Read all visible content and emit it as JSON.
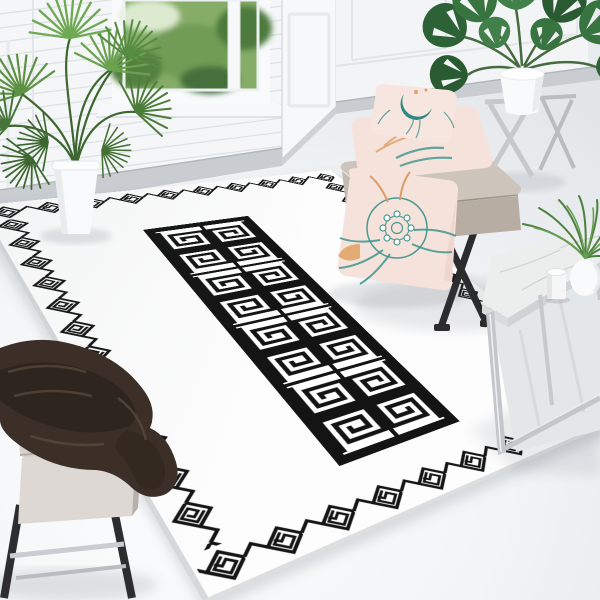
{
  "meta": {
    "type": "product-photograph",
    "description": "Black and white Greek key (meander) area rug with white ground, staged in a bright white room with plants, a bench with blush pillows, a marble side table and a stool with a dark brown throw"
  },
  "palette": {
    "wall": "#f4f6f7",
    "wall_line": "#dde1e4",
    "baseboard": "#c9cdd2",
    "rug_white": "#fdfdfd",
    "ink": "#141414",
    "rug_edge": "#d6d9db",
    "glass_green": "#86ad68",
    "leaf_light": "#6aa24f",
    "leaf_mid": "#4c7c3a",
    "leaf_dark": "#2d6136",
    "pot_white": "#f9fafb",
    "bench_top": "#cdc5bc",
    "bench_front": "#b7ada3",
    "bench_leg": "#2c2c2f",
    "pillow_blush": "#f5e2da",
    "pillow_teal": "#2f8783",
    "pillow_orange": "#dfa06b",
    "stool_cushion": "#d7d1cb",
    "blanket_brown": "#3b2f28",
    "marble": "#eceded",
    "chrome": "#c3c7cb",
    "stand_grey": "#c6c9cc",
    "shadow": "#4a5160"
  },
  "scene": {
    "room": {
      "left_wall": "white shiplap wall with window to garden",
      "right_wall": "white panelled wainscot wall",
      "floor": "pale grey-white floor"
    },
    "rug": {
      "ground_color": "white",
      "pattern_color": "black",
      "border_motif": "diamond fret chain with spiral hooks",
      "center_panel": {
        "rows": 2,
        "cols": 8,
        "motif": "square Greek key spiral tiles framed in black"
      }
    },
    "objects": [
      {
        "name": "palm-plant",
        "container": "white tapered pot"
      },
      {
        "name": "monstera-plant",
        "container": "white pot on grey folding stand"
      },
      {
        "name": "bench",
        "upholstery": "taupe with black X legs"
      },
      {
        "name": "stacked-pillows",
        "count": 2,
        "print": "teal crescent and botanicals on blush"
      },
      {
        "name": "floor-pillow",
        "print": "teal floral mandala with orange sprigs on blush"
      },
      {
        "name": "side-table",
        "top": "white marble, chrome legs"
      },
      {
        "name": "candle",
        "color": "white"
      },
      {
        "name": "table-plant",
        "container": "white round vase"
      },
      {
        "name": "stool",
        "cushion": "greige, dark legs, chrome rails"
      },
      {
        "name": "throw-blanket",
        "color": "dark chocolate brown"
      }
    ]
  }
}
